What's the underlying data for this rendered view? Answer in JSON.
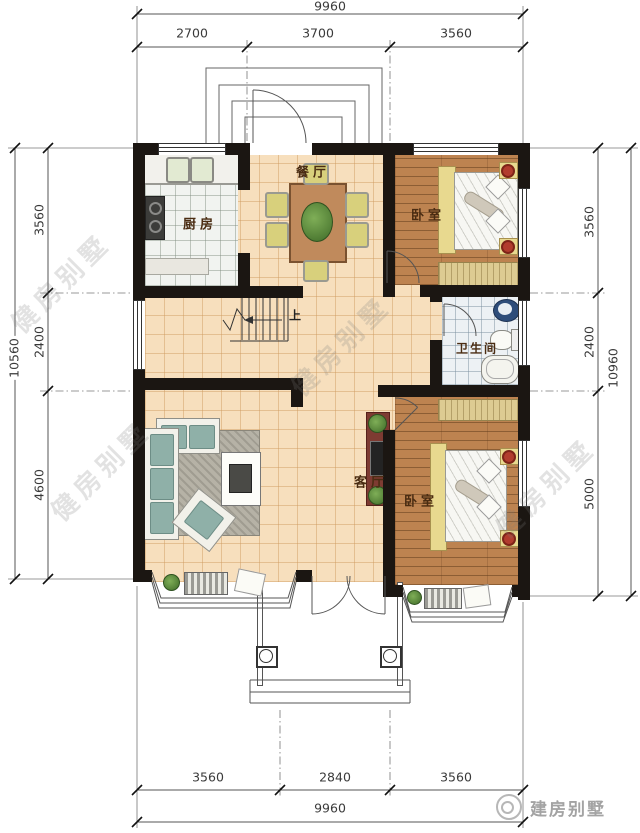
{
  "dimensions": {
    "top": {
      "total": "9960",
      "segments": [
        "2700",
        "3700",
        "3560"
      ]
    },
    "bottom": {
      "total": "9960",
      "segments": [
        "3560",
        "2840",
        "3560"
      ]
    },
    "left": {
      "total": "10560",
      "segments": [
        "3560",
        "2400",
        "4600"
      ]
    },
    "right": {
      "total": "10960",
      "segments": [
        "3560",
        "2400",
        "5000"
      ]
    }
  },
  "rooms": {
    "kitchen": "厨房",
    "dining": "餐厅",
    "bedroom_top": "卧室",
    "bathroom": "卫生间",
    "living": "客厅",
    "bedroom_bottom": "卧室",
    "stairs_up_label": "上"
  },
  "watermark": {
    "text": "健房别墅"
  },
  "logo": {
    "text": "建房别墅"
  },
  "colors": {
    "wall": "#1b1612",
    "floor_tile": "#f7dfbd",
    "floor_wood": "#bd8350",
    "kitchen_tile": "#f1f3f0",
    "bath_tile": "#edf1f4",
    "accent_red": "#b23c2e",
    "tv_cabinet": "#7e3b32",
    "dim_text": "#3a3a3a"
  }
}
